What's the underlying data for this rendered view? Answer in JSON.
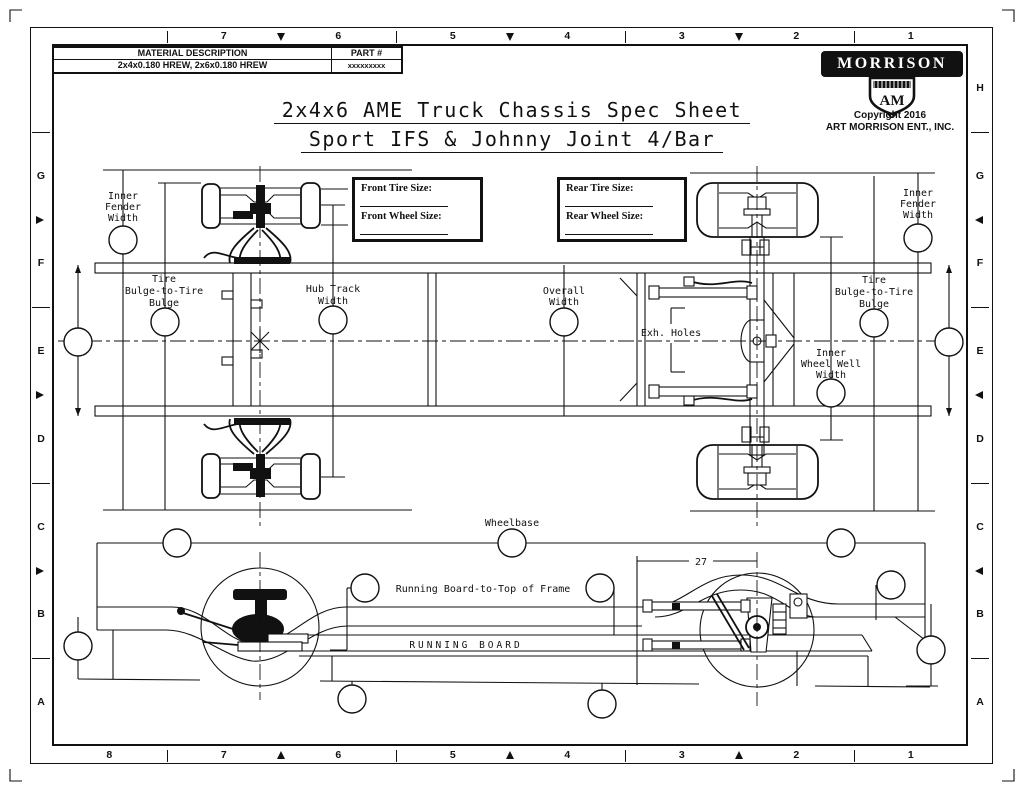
{
  "sheet_title": {
    "line1": "2x4x6 AME Truck Chassis Spec Sheet",
    "line2": "Sport IFS & Johnny Joint 4/Bar"
  },
  "title_block": {
    "material_header": "MATERIAL DESCRIPTION",
    "part_header": "PART #",
    "material_value": "2x4x0.180 HREW, 2x6x0.180 HREW",
    "part_value": "xxxxxxxxx"
  },
  "logo": {
    "brand": "MORRISON",
    "monogram": "AM",
    "copyright": "Copyright 2016",
    "company": "ART MORRISON ENT., INC."
  },
  "border": {
    "columns_top": [
      "",
      "7",
      "6",
      "5",
      "4",
      "3",
      "2",
      "1"
    ],
    "columns_bottom": [
      "8",
      "7",
      "6",
      "5",
      "4",
      "3",
      "2",
      "1"
    ],
    "rows_left": [
      "",
      "G",
      "F",
      "E",
      "D",
      "C",
      "B",
      "A"
    ],
    "rows_right": [
      "H",
      "G",
      "F",
      "E",
      "D",
      "C",
      "B",
      "A"
    ]
  },
  "spec_boxes": {
    "front_tire_label": "Front Tire Size:",
    "front_wheel_label": "Front Wheel Size:",
    "rear_tire_label": "Rear Tire Size:",
    "rear_wheel_label": "Rear Wheel Size:"
  },
  "dimension_labels": {
    "inner_fender_left": [
      "Inner",
      "Fender",
      "Width"
    ],
    "tire_bulge_left": [
      "Tire",
      "Bulge-to-Tire",
      "Bulge"
    ],
    "hub_track": [
      "Hub Track",
      "Width"
    ],
    "overall_width": [
      "Overall",
      "Width"
    ],
    "exh_holes": "Exh. Holes",
    "inner_wheel_well": [
      "Inner",
      "Wheel Well",
      "Width"
    ],
    "tire_bulge_right": [
      "Tire",
      "Bulge-to-Tire",
      "Bulge"
    ],
    "inner_fender_right": [
      "Inner",
      "Fender",
      "Width"
    ],
    "wheelbase": "Wheelbase",
    "running_board_to_top": "Running Board-to-Top of Frame",
    "running_board": "RUNNING BOARD",
    "dim_27": "27"
  },
  "colors": {
    "ink": "#111111",
    "paper": "#ffffff"
  }
}
